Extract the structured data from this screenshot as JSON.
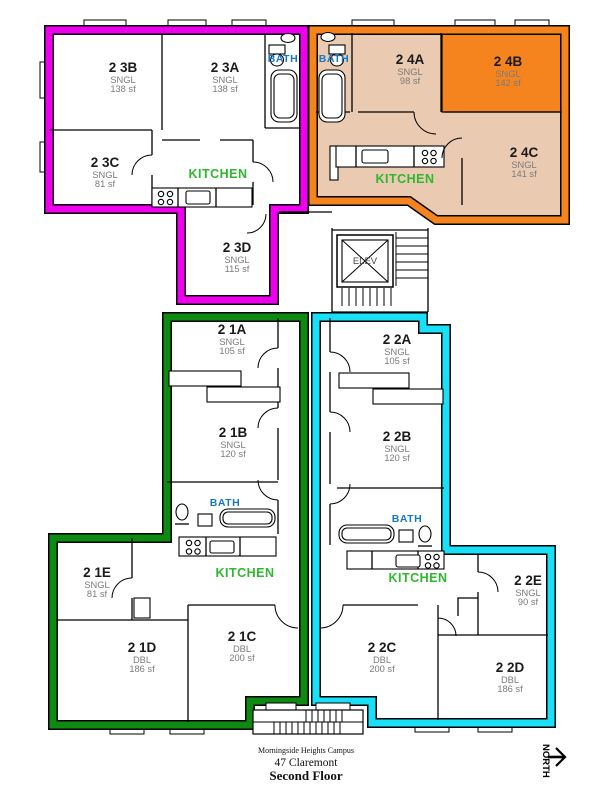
{
  "floor_plan": {
    "campus": "Morningside Heights Campus",
    "building": "47 Claremont",
    "floor": "Second Floor",
    "north_label": "NORTH",
    "elevator_label": "ELEV"
  },
  "labels": {
    "bath": "BATH",
    "kitchen": "KITCHEN"
  },
  "colors": {
    "suite_23_outline": "#EE00EE",
    "suite_24_outline": "#F5841F",
    "suite_24_fill": "#EACBB1",
    "room_24B_fill": "#F5841F",
    "suite_21_outline": "#0E8A12",
    "suite_22_outline": "#19E0F7",
    "bath_label": "#1778C8",
    "kitchen_label": "#2EB82E",
    "room_sub_text": "#7A7A7A",
    "wall": "#000000"
  },
  "suites": [
    {
      "id": "2 3",
      "outline": "magenta",
      "rooms": [
        {
          "id": "2 3B",
          "type": "SNGL",
          "area": "138 sf"
        },
        {
          "id": "2 3A",
          "type": "SNGL",
          "area": "138 sf"
        },
        {
          "id": "2 3C",
          "type": "SNGL",
          "area": "81 sf"
        },
        {
          "id": "2 3D",
          "type": "SNGL",
          "area": "115 sf"
        }
      ]
    },
    {
      "id": "2 4",
      "outline": "orange",
      "rooms": [
        {
          "id": "2 4A",
          "type": "SNGL",
          "area": "98 sf"
        },
        {
          "id": "2 4B",
          "type": "SNGL",
          "area": "142 sf"
        },
        {
          "id": "2 4C",
          "type": "SNGL",
          "area": "141 sf"
        }
      ]
    },
    {
      "id": "2 1",
      "outline": "green",
      "rooms": [
        {
          "id": "2 1A",
          "type": "SNGL",
          "area": "105 sf"
        },
        {
          "id": "2 1B",
          "type": "SNGL",
          "area": "120 sf"
        },
        {
          "id": "2 1E",
          "type": "SNGL",
          "area": "81 sf"
        },
        {
          "id": "2 1D",
          "type": "DBL",
          "area": "186 sf"
        },
        {
          "id": "2 1C",
          "type": "DBL",
          "area": "200 sf"
        }
      ]
    },
    {
      "id": "2 2",
      "outline": "cyan",
      "rooms": [
        {
          "id": "2 2A",
          "type": "SNGL",
          "area": "105 sf"
        },
        {
          "id": "2 2B",
          "type": "SNGL",
          "area": "120 sf"
        },
        {
          "id": "2 2E",
          "type": "SNGL",
          "area": "90 sf"
        },
        {
          "id": "2 2C",
          "type": "DBL",
          "area": "200 sf"
        },
        {
          "id": "2 2D",
          "type": "DBL",
          "area": "186 sf"
        }
      ]
    }
  ]
}
